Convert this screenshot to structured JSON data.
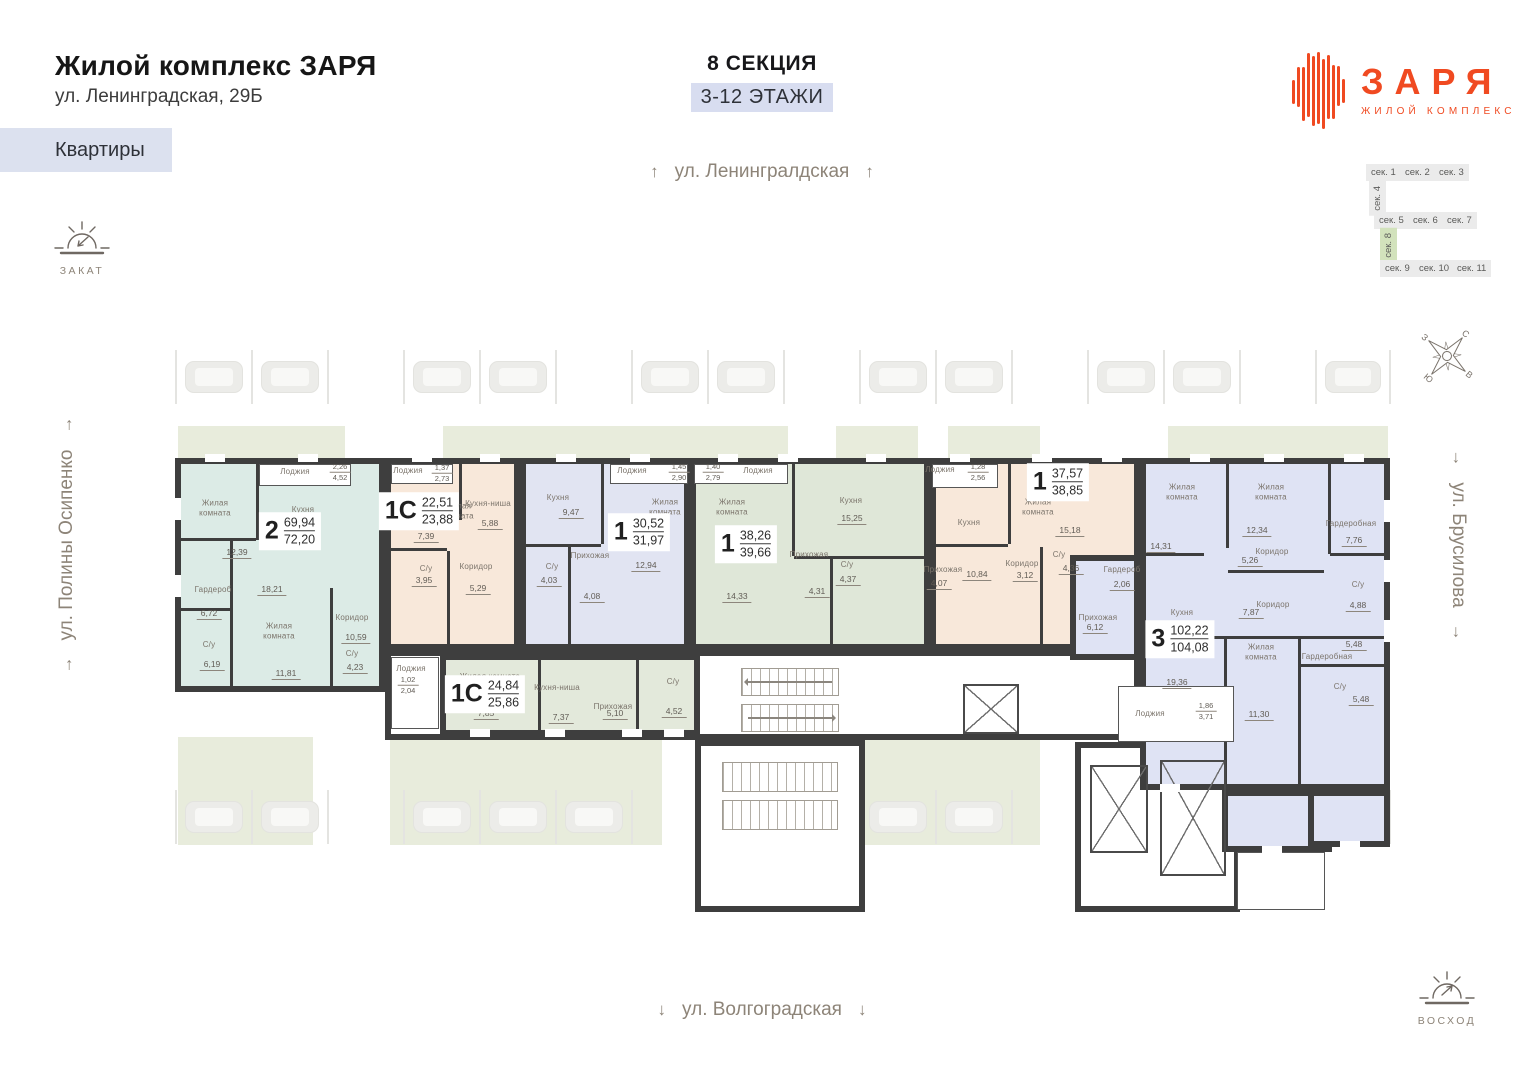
{
  "header": {
    "title": "Жилой комплекс ЗАРЯ",
    "address": "ул. Ленинградская, 29Б",
    "tab": "Квартиры"
  },
  "section_info": {
    "title": "8 СЕКЦИЯ",
    "floors": "3-12 ЭТАЖИ"
  },
  "logo": {
    "name": "ЗАРЯ",
    "subtitle": "ЖИЛОЙ КОМПЛЕКС"
  },
  "sun": {
    "sunset": "ЗАКАТ",
    "sunrise": "ВОСХОД"
  },
  "compass": {
    "north": "С",
    "east": "В",
    "south": "Ю",
    "west": "З"
  },
  "streets": {
    "top": "ул. Ленингралдская",
    "bottom": "ул. Волгоградская",
    "left": "ул. Полины Осипенко",
    "right": "ул. Брусилова"
  },
  "section_map": {
    "chips": [
      "сек. 1",
      "сек. 2",
      "сек. 3",
      "сек. 4",
      "сек. 5",
      "сек. 6",
      "сек. 7",
      "сек. 8",
      "сек. 9",
      "сек. 10",
      "сек. 11"
    ],
    "active": "сек. 8"
  },
  "colors": {
    "accent": "#f04a21",
    "active_section": "#d2e2bc",
    "chip_bg": "#dce1ef",
    "walls": "#3e3e3e"
  },
  "apartments": [
    {
      "type": "2",
      "area_living": "69,94",
      "area_total": "72,20",
      "rooms": [
        {
          "name": "Лоджия",
          "area": "2,26",
          "area2": "4,52"
        },
        {
          "name": "Жилая комната",
          "area": "12,39"
        },
        {
          "name": "Кухня",
          "area": "18,21"
        },
        {
          "name": "Гардероб",
          "area": "6,72"
        },
        {
          "name": "Жилая комната",
          "area": "11,81"
        },
        {
          "name": "С/у",
          "area": "6,19"
        },
        {
          "name": "Коридор",
          "area": "10,59"
        },
        {
          "name": "С/у",
          "area": "4,23"
        }
      ]
    },
    {
      "type": "1С",
      "area_living": "22,51",
      "area_total": "23,88",
      "rooms": [
        {
          "name": "Лоджия",
          "area": "1,37",
          "area2": "2,73"
        },
        {
          "name": "Жилая комната",
          "area": "7,39"
        },
        {
          "name": "Кухня-ниша",
          "area": "5,88"
        },
        {
          "name": "С/у",
          "area": "3,95"
        },
        {
          "name": "Коридор",
          "area": "5,29"
        }
      ]
    },
    {
      "type": "1",
      "area_living": "30,52",
      "area_total": "31,97",
      "rooms": [
        {
          "name": "Лоджия",
          "area": "1,45",
          "area2": "2,90"
        },
        {
          "name": "Кухня",
          "area": "9,47"
        },
        {
          "name": "Жилая комната",
          "area": "12,94"
        },
        {
          "name": "Прихожая",
          "area": "4,08"
        },
        {
          "name": "С/у",
          "area": "4,03"
        }
      ]
    },
    {
      "type": "1",
      "area_living": "38,26",
      "area_total": "39,66",
      "rooms": [
        {
          "name": "Лоджия",
          "area": "1,40",
          "area2": "2,79"
        },
        {
          "name": "Жилая комната",
          "area": "14,33"
        },
        {
          "name": "Кухня",
          "area": "15,25"
        },
        {
          "name": "Прихожая",
          "area": "4,31"
        },
        {
          "name": "С/у",
          "area": "4,37"
        }
      ]
    },
    {
      "type": "1",
      "area_living": "37,57",
      "area_total": "38,85",
      "rooms": [
        {
          "name": "Лоджия",
          "area": "1,28",
          "area2": "2,56"
        },
        {
          "name": "Кухня",
          "area": "10,84"
        },
        {
          "name": "Жилая комната",
          "area": "15,18"
        },
        {
          "name": "Прихожая",
          "area": "4,07"
        },
        {
          "name": "Коридор",
          "area": "3,12"
        },
        {
          "name": "С/у",
          "area": "4,36"
        }
      ]
    },
    {
      "type": "3",
      "area_living": "102,22",
      "area_total": "104,08",
      "rooms": [
        {
          "name": "Жилая комната",
          "area": "14,31"
        },
        {
          "name": "Жилая комната",
          "area": "12,34"
        },
        {
          "name": "Гардеробная",
          "area": "7,76"
        },
        {
          "name": "Коридор",
          "area": "5,26"
        },
        {
          "name": "Гардероб",
          "area": "2,06"
        },
        {
          "name": "Прихожая",
          "area": "6,12"
        },
        {
          "name": "Кухня",
          "area": "19,36"
        },
        {
          "name": "Коридор",
          "area": "7,87"
        },
        {
          "name": "С/у",
          "area": "4,88"
        },
        {
          "name": "Жилая комната",
          "area": "11,30"
        },
        {
          "name": "Гардеробная",
          "area": "5,48"
        },
        {
          "name": "С/у",
          "area": "5,48"
        },
        {
          "name": "Лоджия",
          "area": "1,86",
          "area2": "3,71"
        }
      ]
    },
    {
      "type": "1С",
      "area_living": "24,84",
      "area_total": "25,86",
      "rooms": [
        {
          "name": "Лоджия",
          "area": "1,02",
          "area2": "2,04"
        },
        {
          "name": "Жилая комната",
          "area": "7,85"
        },
        {
          "name": "Кухня-ниша",
          "area": "7,37"
        },
        {
          "name": "Прихожая",
          "area": "5,10"
        },
        {
          "name": "С/у",
          "area": "4,52"
        }
      ]
    }
  ],
  "parking": {
    "top": [
      1,
      1,
      0,
      1,
      1,
      0,
      1,
      1,
      0,
      1,
      1,
      0,
      1,
      1,
      0,
      1
    ],
    "bottom": [
      1,
      1,
      0,
      1,
      1,
      1,
      0,
      1,
      0,
      1,
      1,
      0,
      1,
      1,
      1,
      0
    ]
  }
}
